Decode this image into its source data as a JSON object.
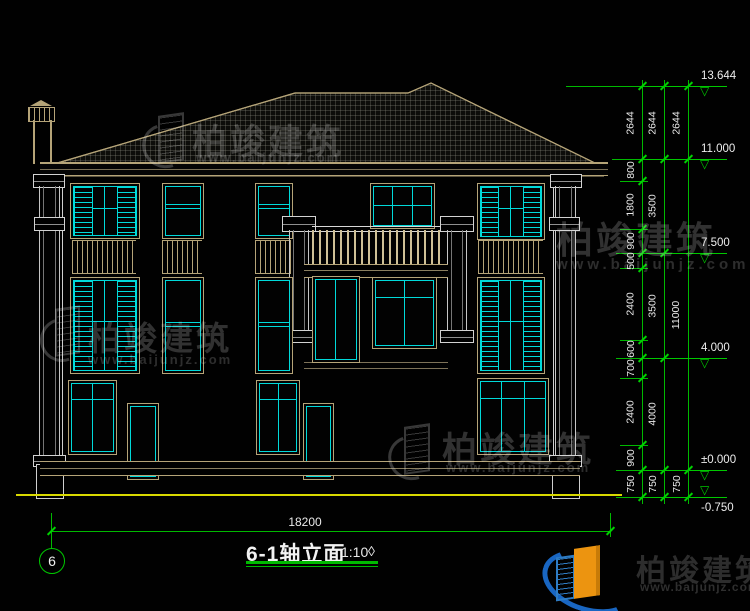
{
  "colors": {
    "dim_green": "#00b900",
    "window_cyan": "#00d9d9",
    "frame_tan": "#b5a478",
    "ground_yellow": "#d8d800",
    "wall_white": "#cfcfcf"
  },
  "watermark": {
    "brand": "柏竣建筑",
    "url": "www.baijunjz.com"
  },
  "title_block": {
    "axis_label": "6",
    "title": "6-1轴立面",
    "scale": "1:10",
    "diamond": "◊"
  },
  "dimensions": {
    "bottom": {
      "label": "18200"
    },
    "levels": [
      {
        "label": "13.644",
        "y": 86,
        "flip": false
      },
      {
        "label": "11.000",
        "y": 159,
        "flip": false
      },
      {
        "label": "7.500",
        "y": 253,
        "flip": false
      },
      {
        "label": "4.000",
        "y": 358,
        "flip": false
      },
      {
        "label": "±0.000",
        "y": 470,
        "flip": false
      },
      {
        "label": "-0.750",
        "y": 497,
        "flip": true
      }
    ],
    "boundaries": [
      {
        "y": 86,
        "x1": 566,
        "x2": 694
      },
      {
        "y": 159,
        "x1": 612,
        "x2": 694
      },
      {
        "y": 181,
        "x1": 620,
        "x2": 648
      },
      {
        "y": 229,
        "x1": 620,
        "x2": 648
      },
      {
        "y": 253,
        "x1": 616,
        "x2": 670
      },
      {
        "y": 268,
        "x1": 620,
        "x2": 648
      },
      {
        "y": 340,
        "x1": 620,
        "x2": 648
      },
      {
        "y": 358,
        "x1": 616,
        "x2": 670
      },
      {
        "y": 378,
        "x1": 620,
        "x2": 648
      },
      {
        "y": 445,
        "x1": 620,
        "x2": 648
      },
      {
        "y": 470,
        "x1": 616,
        "x2": 694
      },
      {
        "y": 497,
        "x1": 616,
        "x2": 694
      }
    ],
    "chains": [
      {
        "x": 642,
        "segments": [
          [
            "2644",
            86,
            159
          ],
          [
            "800",
            159,
            181
          ],
          [
            "1800",
            181,
            229
          ],
          [
            "900",
            229,
            253
          ],
          [
            "500",
            253,
            268
          ],
          [
            "2400",
            268,
            340
          ],
          [
            "600",
            340,
            358
          ],
          [
            "700",
            358,
            378
          ],
          [
            "2400",
            378,
            445
          ],
          [
            "900",
            445,
            470
          ],
          [
            "750",
            470,
            497
          ]
        ]
      },
      {
        "x": 664,
        "segments": [
          [
            "2644",
            86,
            159
          ],
          [
            "3500",
            159,
            253
          ],
          [
            "3500",
            253,
            358
          ],
          [
            "4000",
            358,
            470
          ],
          [
            "750",
            470,
            497
          ]
        ]
      },
      {
        "x": 688,
        "segments": [
          [
            "2644",
            86,
            159
          ],
          [
            "11000",
            159,
            470
          ],
          [
            "750",
            470,
            497
          ]
        ]
      }
    ]
  }
}
